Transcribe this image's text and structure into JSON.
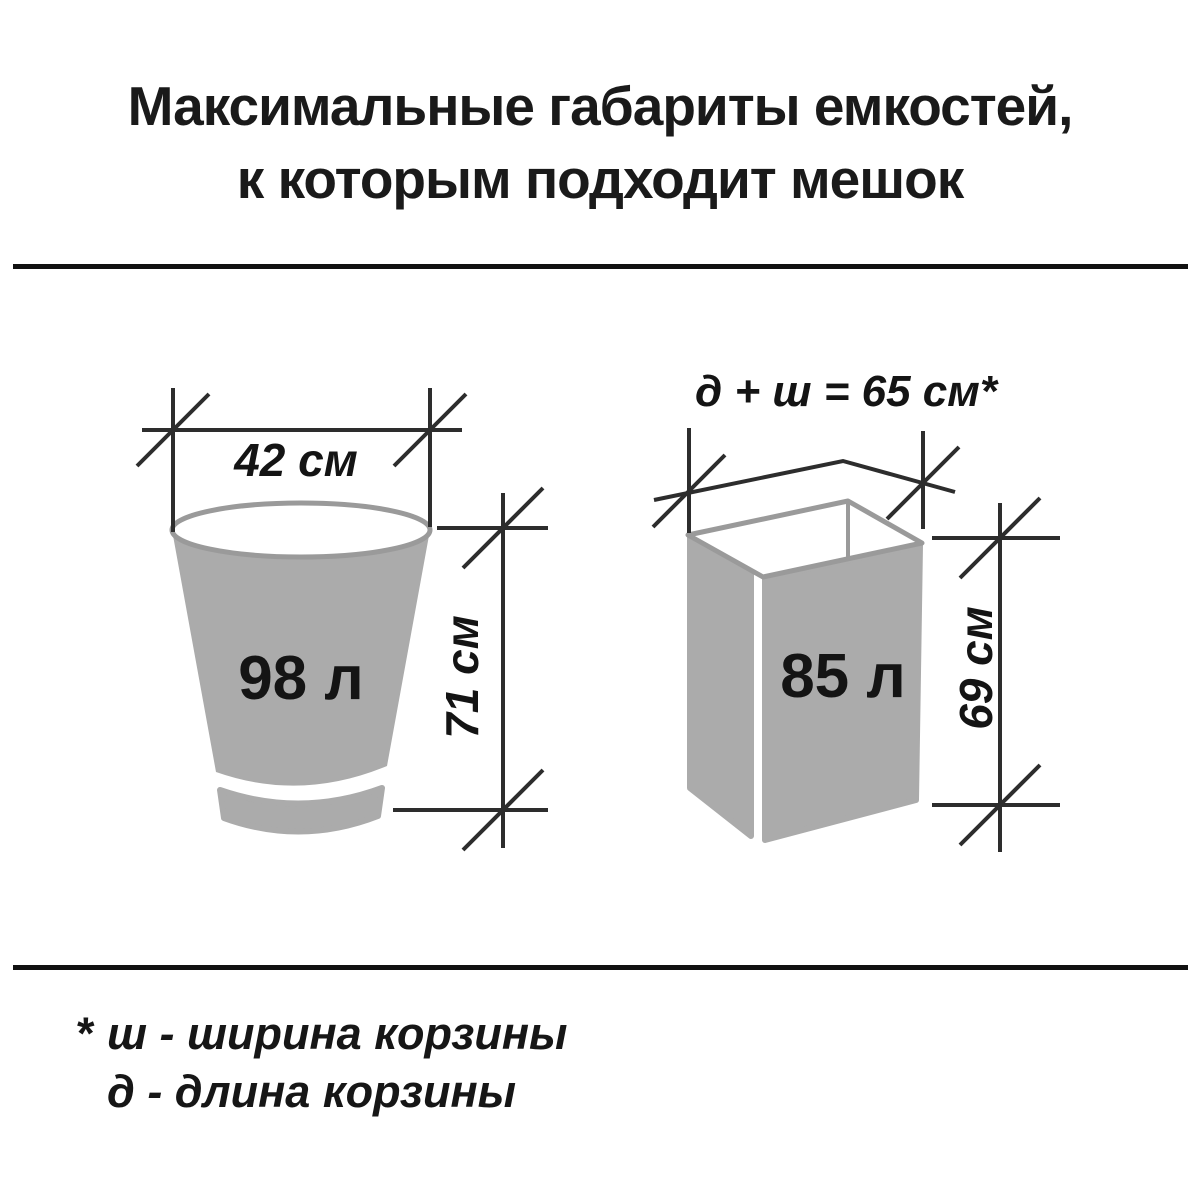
{
  "title": {
    "line1": "Максимальные габариты емкостей,",
    "line2": "к которым подходит мешок"
  },
  "diagrams": {
    "round_bin": {
      "top_width": "42 см",
      "volume": "98 л",
      "height": "71 см"
    },
    "rect_bin": {
      "top_formula": "д + ш = 65 см*",
      "volume": "85 л",
      "height": "69 см"
    }
  },
  "footnote": {
    "marker": "*",
    "line1": "ш - ширина корзины",
    "line2": "д - длина корзины"
  },
  "colors": {
    "background": "#ffffff",
    "container_fill": "#ababab",
    "rim_stroke": "#9a9a9a",
    "dimension_line": "#2d2d2d",
    "text": "#141414",
    "divider": "#111111"
  }
}
